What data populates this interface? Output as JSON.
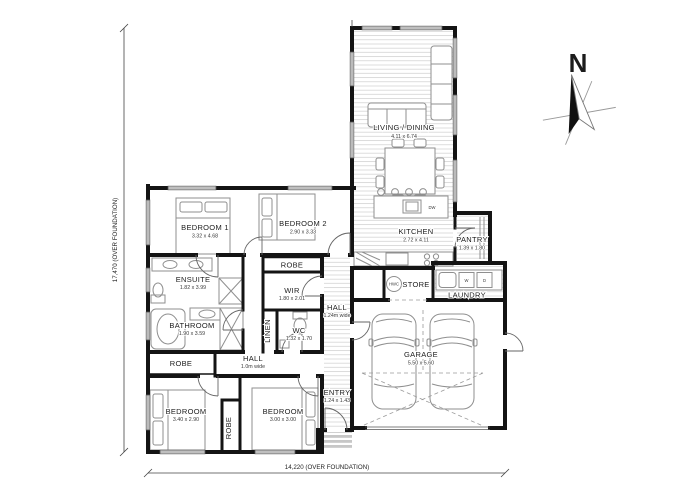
{
  "plan": {
    "north_label": "N",
    "dimensions": {
      "left": "17,470 (OVER FOUNDATION)",
      "bottom": "14,220 (OVER FOUNDATION)"
    },
    "rooms": {
      "living": {
        "name": "LIVING / DINING",
        "size": "4.11 x 6.74"
      },
      "kitchen": {
        "name": "KITCHEN",
        "size": "2.72 x 4.11"
      },
      "pantry": {
        "name": "PANTRY",
        "size": "1.39 x 1.80"
      },
      "store": {
        "name": "STORE"
      },
      "laundry": {
        "name": "LAUNDRY"
      },
      "garage": {
        "name": "GARAGE",
        "size": "5.50 x 5.60"
      },
      "hall_garage": {
        "name": "HALL",
        "size": "1.24m wide"
      },
      "entry": {
        "name": "ENTRY",
        "size": "1.24 x 1.43"
      },
      "bedroom1": {
        "name": "BEDROOM 1",
        "size": "3.32 x 4.68"
      },
      "bedroom2": {
        "name": "BEDROOM 2",
        "size": "2.90 x 3.33"
      },
      "robe_bed2": {
        "name": "ROBE"
      },
      "wir": {
        "name": "WIR",
        "size": "1.80 x 2.01"
      },
      "ensuite": {
        "name": "ENSUITE",
        "size": "1.82 x 3.99"
      },
      "bathroom": {
        "name": "BATHROOM",
        "size": "1.90 x 3.59"
      },
      "wc": {
        "name": "WC",
        "size": "1.32 x 1.70"
      },
      "linen": {
        "name": "LINEN"
      },
      "robe_hall": {
        "name": "ROBE"
      },
      "hall_main": {
        "name": "HALL",
        "size": "1.0m wide"
      },
      "bedroom3": {
        "name": "BEDROOM",
        "size": "3.40 x 2.90"
      },
      "robe_beds": {
        "name": "ROBE"
      },
      "bedroom4": {
        "name": "BEDROOM",
        "size": "3.00 x 3.00"
      }
    },
    "appliances": {
      "hwc": "HWC",
      "washer": "W",
      "dryer": "D",
      "dishwasher": "DW"
    },
    "colors": {
      "wall": "#141414",
      "furniture": "#8f8f8f",
      "hatch": "#cdcdcd"
    }
  }
}
